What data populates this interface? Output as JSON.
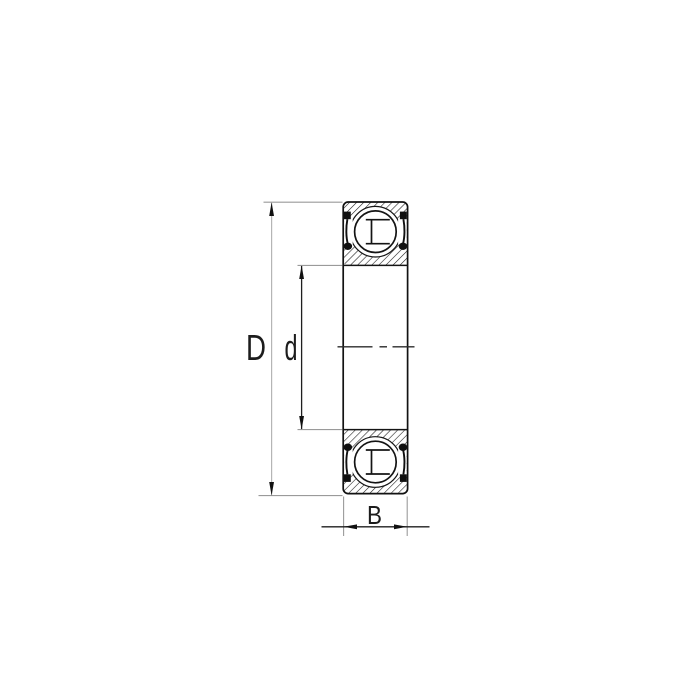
{
  "drawing": {
    "name": "ball-bearing-sectional-view",
    "labels": {
      "outer_diameter": "D",
      "inner_diameter": "d",
      "width": "B"
    },
    "colors": {
      "ink": "#161616",
      "hatch": "#1c1c1c",
      "dim_line_outer": "#b5b5b5",
      "dim_line_inner": "#1f1f1f",
      "extension_line": "#9a9a9a",
      "arrow": "#111111",
      "background": "#ffffff"
    }
  }
}
